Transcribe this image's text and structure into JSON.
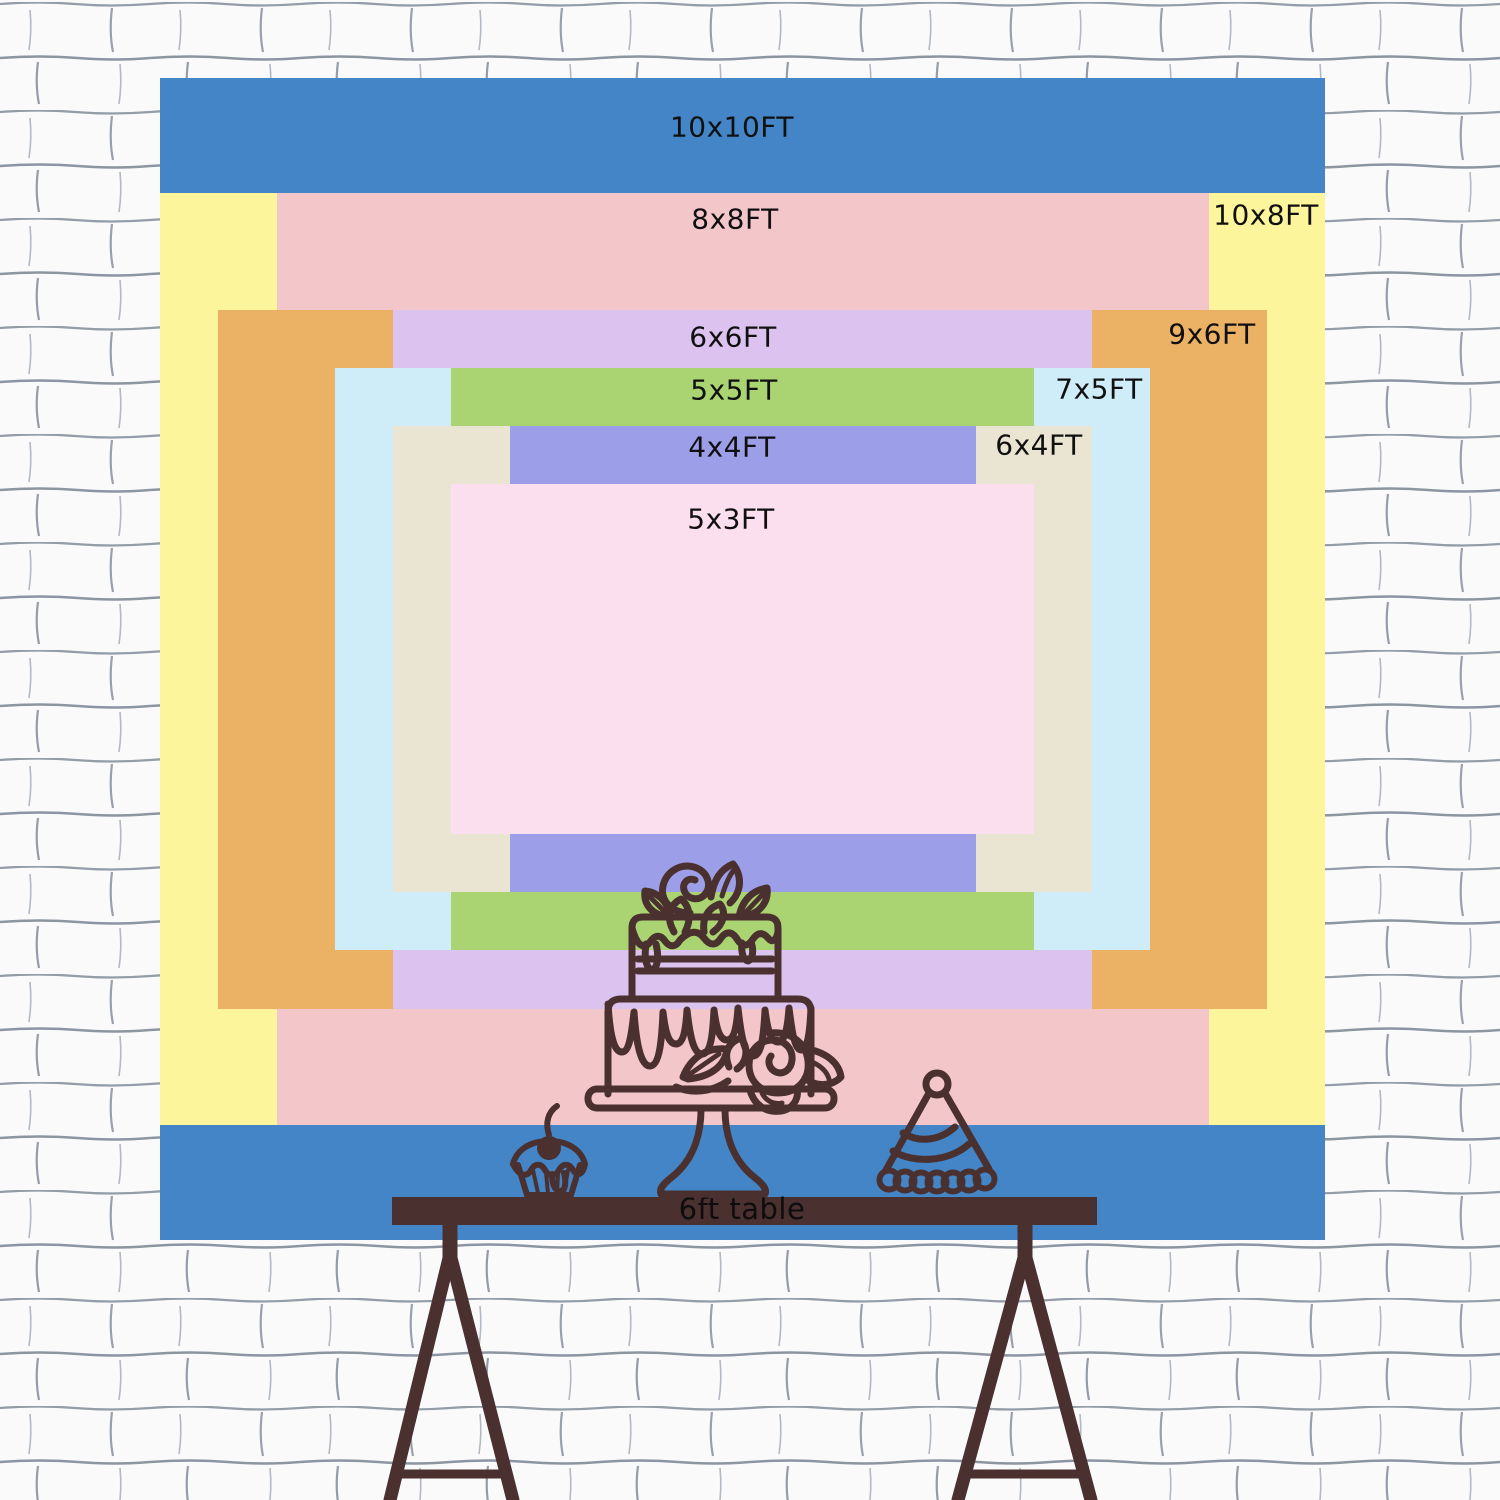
{
  "scene": {
    "description": "Backdrop size chart of nested colored rectangles hung on a white painted brick wall, above a 6ft trestle table with hand-drawn cake, cupcake and party-hat line art"
  },
  "chart_data": {
    "type": "nested-rectangles size comparison chart",
    "unit": "FT",
    "px_per_ft": 116.5,
    "canvas": {
      "left": 160,
      "top": 78,
      "width": 1165,
      "height": 1162
    },
    "alignment": "all rectangles centered on a common center, painted in listed order",
    "sizes": [
      {
        "label": "10x10FT",
        "w_ft": 10,
        "h_ft": 10,
        "color": "#4385c6",
        "label_pos": {
          "x": 572,
          "y": 49
        }
      },
      {
        "label": "10x8FT",
        "w_ft": 10,
        "h_ft": 8,
        "color": "#fcf59c",
        "label_pos": {
          "x": 1106,
          "y": 137
        }
      },
      {
        "label": "8x8FT",
        "w_ft": 8,
        "h_ft": 8,
        "color": "#f3c7c9",
        "label_pos": {
          "x": 575,
          "y": 141
        }
      },
      {
        "label": "9x6FT",
        "w_ft": 9,
        "h_ft": 6,
        "color": "#ebb265",
        "label_pos": {
          "x": 1052,
          "y": 256
        }
      },
      {
        "label": "6x6FT",
        "w_ft": 6,
        "h_ft": 6,
        "color": "#dcc2ef",
        "label_pos": {
          "x": 573,
          "y": 259
        }
      },
      {
        "label": "7x5FT",
        "w_ft": 7,
        "h_ft": 5,
        "color": "#cfecf9",
        "label_pos": {
          "x": 939,
          "y": 311
        }
      },
      {
        "label": "5x5FT",
        "w_ft": 5,
        "h_ft": 5,
        "color": "#a9d471",
        "label_pos": {
          "x": 574,
          "y": 312
        }
      },
      {
        "label": "6x4FT",
        "w_ft": 6,
        "h_ft": 4,
        "color": "#e9e5d2",
        "label_pos": {
          "x": 879,
          "y": 367
        }
      },
      {
        "label": "4x4FT",
        "w_ft": 4,
        "h_ft": 4,
        "color": "#9c9fe8",
        "label_pos": {
          "x": 572,
          "y": 369
        }
      },
      {
        "label": "5x3FT",
        "w_ft": 5,
        "h_ft": 3,
        "color": "#fcdfee",
        "label_pos": {
          "x": 571,
          "y": 441
        }
      }
    ]
  },
  "table": {
    "label": "6ft table",
    "color": "#4a3130"
  },
  "decorations": [
    {
      "name": "tiered-cake-illustration"
    },
    {
      "name": "cupcake-illustration"
    },
    {
      "name": "party-hat-illustration"
    }
  ],
  "colors": {
    "wall_background": "#fafafa",
    "wall_mortar_line": "#9199a5",
    "line_art": "#4a3130",
    "label_text": "#101010"
  }
}
